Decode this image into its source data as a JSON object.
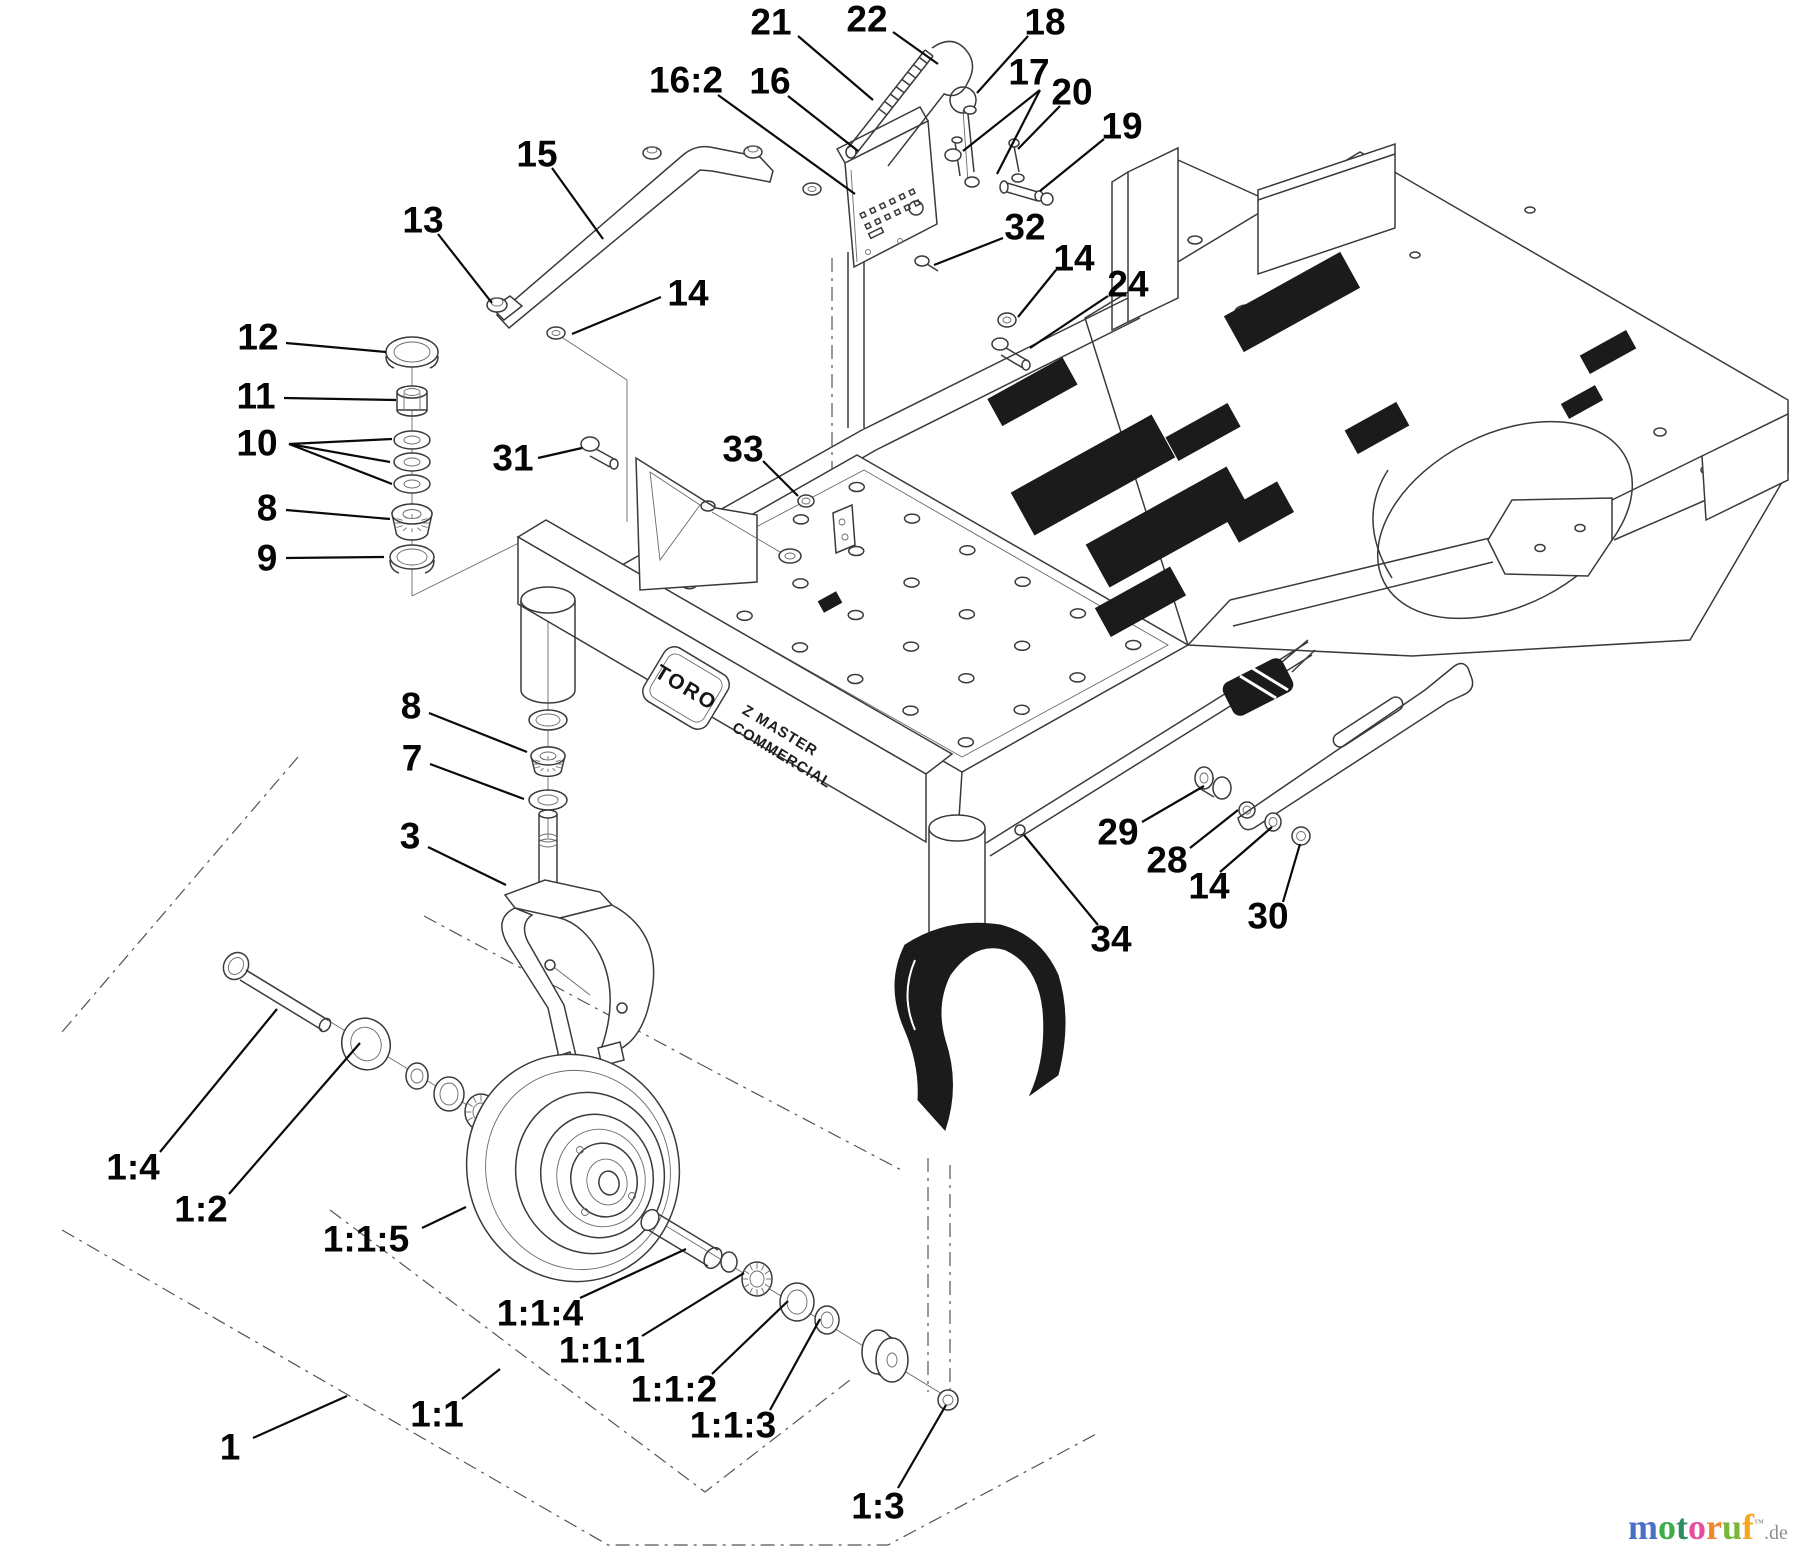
{
  "diagram": {
    "type": "exploded-parts-diagram",
    "brand": {
      "toro": "TORO",
      "model_line1": "Z MASTER",
      "model_line2": "COMMERCIAL"
    },
    "watermark": {
      "letters": [
        {
          "ch": "m",
          "color": "#4a72c4"
        },
        {
          "ch": "o",
          "color": "#3fae49"
        },
        {
          "ch": "t",
          "color": "#2e8b62"
        },
        {
          "ch": "o",
          "color": "#e64fa0"
        },
        {
          "ch": "r",
          "color": "#f0882a"
        },
        {
          "ch": "u",
          "color": "#7ab63c"
        },
        {
          "ch": "f",
          "color": "#f5a81e"
        }
      ],
      "tm": "™",
      "suffix": ".de",
      "suffix_color": "#8f8f8f"
    },
    "colors": {
      "line": "#3a3a3a",
      "label": "#050505",
      "decal": "#1b1b1b",
      "background": "#ffffff"
    },
    "callouts": [
      {
        "label": "21",
        "x": 771,
        "y": 22,
        "leaders": [
          [
            798,
            36,
            873,
            100
          ]
        ]
      },
      {
        "label": "22",
        "x": 867,
        "y": 19,
        "leaders": [
          [
            893,
            32,
            938,
            64
          ]
        ]
      },
      {
        "label": "18",
        "x": 1045,
        "y": 22,
        "leaders": [
          [
            1028,
            36,
            977,
            93
          ]
        ]
      },
      {
        "label": "17",
        "x": 1029,
        "y": 72,
        "leaders": [
          [
            1040,
            90,
            963,
            151
          ],
          [
            1040,
            90,
            997,
            174
          ]
        ]
      },
      {
        "label": "20",
        "x": 1072,
        "y": 92,
        "leaders": [
          [
            1060,
            106,
            1018,
            149
          ]
        ]
      },
      {
        "label": "19",
        "x": 1122,
        "y": 126,
        "leaders": [
          [
            1104,
            139,
            1040,
            191
          ]
        ]
      },
      {
        "label": "16:2",
        "x": 686,
        "y": 80,
        "leaders": [
          [
            718,
            95,
            855,
            194
          ]
        ]
      },
      {
        "label": "16",
        "x": 770,
        "y": 81,
        "leaders": [
          [
            788,
            96,
            858,
            151
          ]
        ]
      },
      {
        "label": "32",
        "x": 1025,
        "y": 227,
        "leaders": [
          [
            1003,
            238,
            934,
            265
          ]
        ]
      },
      {
        "label": "14",
        "x": 1074,
        "y": 258,
        "leaders": [
          [
            1056,
            270,
            1018,
            317
          ]
        ]
      },
      {
        "label": "24",
        "x": 1128,
        "y": 284,
        "leaders": [
          [
            1108,
            296,
            1030,
            348
          ]
        ]
      },
      {
        "label": "15",
        "x": 537,
        "y": 154,
        "leaders": [
          [
            552,
            168,
            603,
            239
          ]
        ]
      },
      {
        "label": "13",
        "x": 423,
        "y": 220,
        "leaders": [
          [
            438,
            234,
            492,
            303
          ]
        ]
      },
      {
        "label": "14",
        "x": 688,
        "y": 293,
        "leaders": [
          [
            661,
            297,
            572,
            334
          ]
        ]
      },
      {
        "label": "12",
        "x": 258,
        "y": 337,
        "leaders": [
          [
            286,
            343,
            386,
            352
          ]
        ]
      },
      {
        "label": "11",
        "x": 256,
        "y": 396,
        "leaders": [
          [
            284,
            398,
            396,
            400
          ]
        ]
      },
      {
        "label": "10",
        "x": 257,
        "y": 443,
        "leaders": [
          [
            289,
            444,
            392,
            439
          ],
          [
            289,
            444,
            390,
            462
          ],
          [
            289,
            444,
            392,
            484
          ]
        ]
      },
      {
        "label": "8",
        "x": 267,
        "y": 508,
        "leaders": [
          [
            286,
            510,
            390,
            519
          ]
        ]
      },
      {
        "label": "9",
        "x": 267,
        "y": 558,
        "leaders": [
          [
            286,
            558,
            384,
            557
          ]
        ]
      },
      {
        "label": "31",
        "x": 513,
        "y": 458,
        "leaders": [
          [
            538,
            458,
            582,
            448
          ]
        ]
      },
      {
        "label": "33",
        "x": 743,
        "y": 449,
        "leaders": [
          [
            763,
            461,
            798,
            496
          ]
        ]
      },
      {
        "label": "8",
        "x": 411,
        "y": 706,
        "leaders": [
          [
            429,
            713,
            527,
            752
          ]
        ]
      },
      {
        "label": "7",
        "x": 412,
        "y": 758,
        "leaders": [
          [
            430,
            764,
            524,
            799
          ]
        ]
      },
      {
        "label": "3",
        "x": 410,
        "y": 836,
        "leaders": [
          [
            428,
            847,
            506,
            885
          ]
        ]
      },
      {
        "label": "29",
        "x": 1118,
        "y": 832,
        "leaders": [
          [
            1142,
            822,
            1204,
            786
          ]
        ]
      },
      {
        "label": "28",
        "x": 1167,
        "y": 860,
        "leaders": [
          [
            1190,
            848,
            1238,
            810
          ]
        ]
      },
      {
        "label": "14",
        "x": 1209,
        "y": 886,
        "leaders": [
          [
            1220,
            872,
            1272,
            827
          ]
        ]
      },
      {
        "label": "30",
        "x": 1268,
        "y": 916,
        "leaders": [
          [
            1283,
            902,
            1300,
            844
          ]
        ]
      },
      {
        "label": "34",
        "x": 1111,
        "y": 939,
        "leaders": [
          [
            1098,
            925,
            1024,
            835
          ]
        ]
      },
      {
        "label": "1:4",
        "x": 133,
        "y": 1167,
        "leaders": [
          [
            160,
            1152,
            277,
            1009
          ]
        ]
      },
      {
        "label": "1:2",
        "x": 201,
        "y": 1209,
        "leaders": [
          [
            229,
            1194,
            360,
            1043
          ]
        ]
      },
      {
        "label": "1:1:5",
        "x": 366,
        "y": 1239,
        "leaders": [
          [
            422,
            1228,
            466,
            1207
          ]
        ]
      },
      {
        "label": "1:1:4",
        "x": 540,
        "y": 1313,
        "leaders": [
          [
            580,
            1298,
            686,
            1249
          ]
        ]
      },
      {
        "label": "1:1:1",
        "x": 602,
        "y": 1350,
        "leaders": [
          [
            642,
            1336,
            744,
            1273
          ]
        ]
      },
      {
        "label": "1:1:2",
        "x": 674,
        "y": 1389,
        "leaders": [
          [
            712,
            1374,
            788,
            1301
          ]
        ]
      },
      {
        "label": "1:1:3",
        "x": 733,
        "y": 1425,
        "leaders": [
          [
            770,
            1410,
            820,
            1319
          ]
        ]
      },
      {
        "label": "1:1",
        "x": 437,
        "y": 1414,
        "leaders": [
          [
            462,
            1399,
            500,
            1369
          ]
        ]
      },
      {
        "label": "1",
        "x": 230,
        "y": 1447,
        "leaders": [
          [
            253,
            1438,
            347,
            1396
          ]
        ]
      },
      {
        "label": "1:3",
        "x": 878,
        "y": 1506,
        "leaders": [
          [
            898,
            1488,
            946,
            1405
          ]
        ]
      }
    ]
  }
}
